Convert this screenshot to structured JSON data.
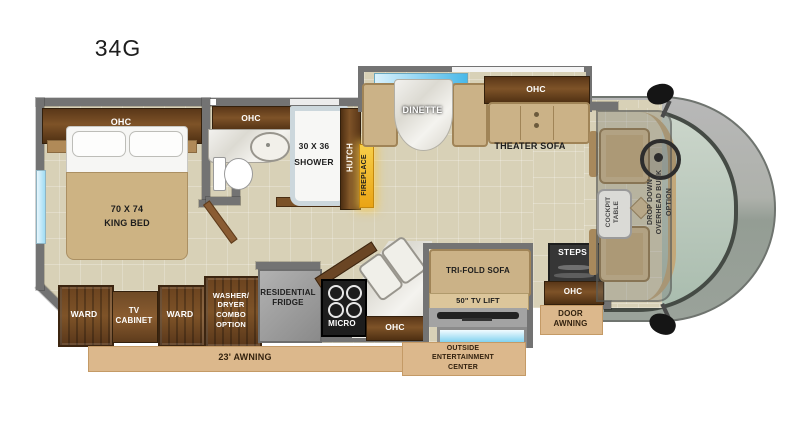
{
  "title": "34G",
  "bedroom": {
    "ohc": "OHC",
    "bed": "70 X 74\nKING BED",
    "ward_left": "WARD",
    "tv_cabinet": "TV\nCABINET",
    "ward_right": "WARD",
    "washer": "WASHER/\nDRYER\nCOMBO\nOPTION"
  },
  "bathroom": {
    "ohc": "OHC",
    "shower": "30 X 36\nSHOWER",
    "hutch": "HUTCH",
    "fireplace": "FIREPLACE"
  },
  "living": {
    "dinette": "DINETTE",
    "theater_ohc": "OHC",
    "theater_sofa": "THEATER SOFA",
    "tri_fold_sofa": "TRI-FOLD SOFA",
    "tv_lift": "50\" TV LIFT"
  },
  "kitchen": {
    "fridge": "RESIDENTIAL\nFRIDGE",
    "micro": "MICRO",
    "ohc": "OHC"
  },
  "entry": {
    "steps": "STEPS",
    "ohc": "OHC",
    "door_awning": "DOOR\nAWNING"
  },
  "cab": {
    "cockpit_table": "COCKPIT\nTABLE",
    "drop_down_bunk": "DROP DOWN\nOVERHEAD BUNK\nOPTION"
  },
  "exterior": {
    "awning": "23' AWNING",
    "outside_entertainment": "OUTSIDE\nENTERTAINMENT\nCENTER"
  },
  "colors": {
    "floor": "#d8d1b7",
    "wall": "#737373",
    "wood": "#6a4524",
    "awning": "#dcb88c",
    "gold": "#f2b71e",
    "glass": "#5ec4ea",
    "upholstery": "#cbb287",
    "marble": "#e9e6df",
    "cab_body": "#a7aba4",
    "windshield": "#b9c6ba"
  }
}
